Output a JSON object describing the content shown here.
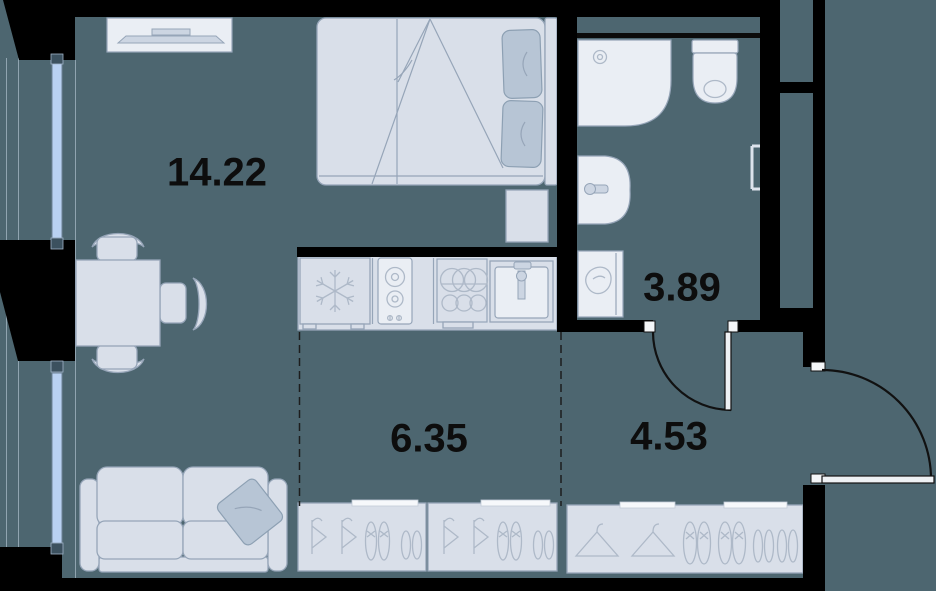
{
  "rooms": [
    {
      "area": "14.22"
    },
    {
      "area": "3.89"
    },
    {
      "area": "6.35"
    },
    {
      "area": "4.53"
    }
  ],
  "colors": {
    "floor": "#4d6670",
    "wall": "#000000",
    "furn-fill": "#d9dfe9",
    "furn-line": "#96a5b8",
    "panel-fill": "#eaeef4",
    "accent-fill": "#b7c5d5",
    "accent-line": "#8da0b3",
    "icon-line": "#aeb9c8",
    "window": "#b9d1f2",
    "wincap": "#3c515f",
    "door-line": "#111111",
    "label": "#0d0d0d",
    "strip": "#f6f8fb",
    "thin-line": "#90a4b0",
    "metal": "#ccd5e2"
  },
  "furniture_icons": [
    "tv-console-icon",
    "double-bed-icon",
    "pillow-icon",
    "nightstand-icon",
    "dining-table-icon",
    "chair-icon",
    "sofa-icon",
    "sofa-pillow-icon",
    "fridge-snowflake-icon",
    "hob-burners-icon",
    "kitchen-sink-icon",
    "shower-tray-icon",
    "toilet-icon",
    "washbasin-icon",
    "washing-machine-icon",
    "towel-rail-icon",
    "hanger-icon",
    "shoes-icon",
    "door-swing-icon",
    "entrance-door-swing-icon",
    "window-icon"
  ]
}
